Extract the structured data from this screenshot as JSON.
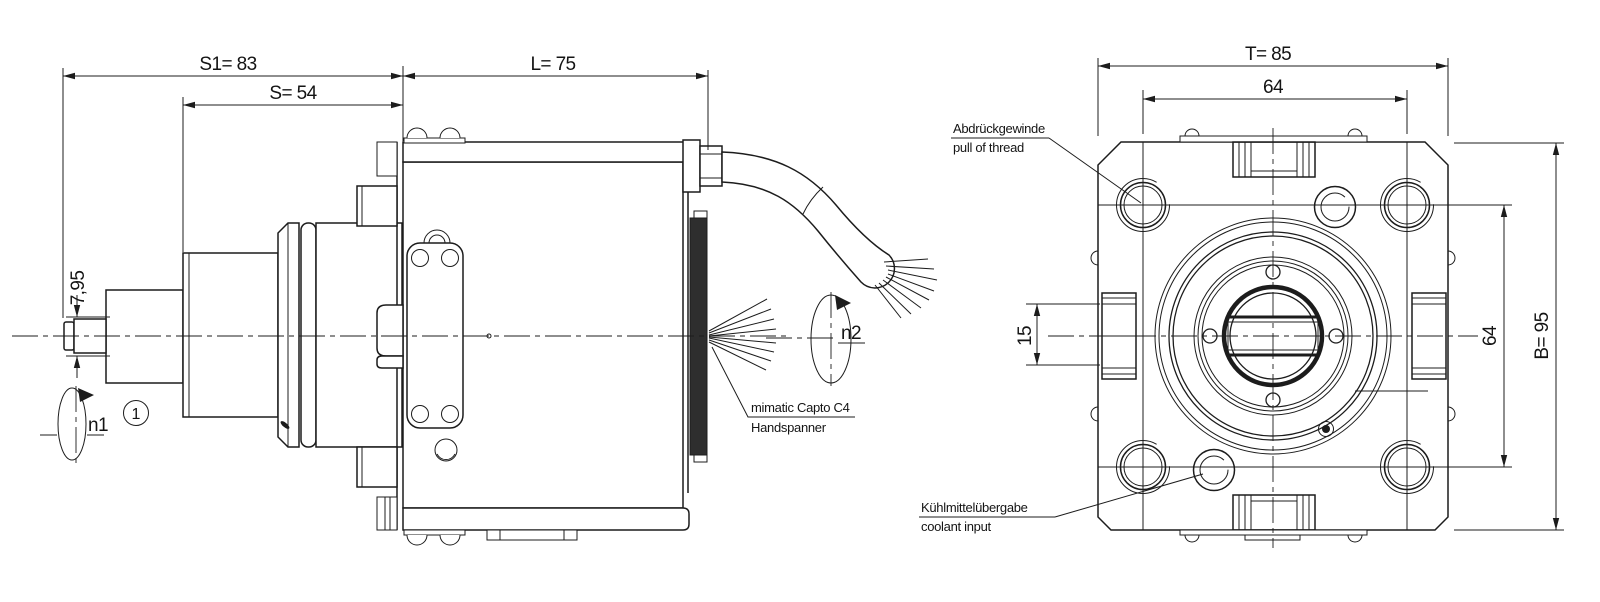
{
  "side_view": {
    "dim_s1": "S1= 83",
    "dim_s": "S= 54",
    "dim_l": "L= 75",
    "dim_shaft_dia": "7,95",
    "speed_label_1": "n1",
    "speed_label_2": "n2",
    "balloon_1": "1",
    "capto_label_line1": "mimatic Capto C4",
    "capto_label_line2": "Handspanner"
  },
  "front_view": {
    "dim_t": "T= 85",
    "dim_width_64": "64",
    "dim_b": "B= 95",
    "dim_height_64": "64",
    "dim_clamp_15": "15",
    "thread_label_line1": "Abdrückgewinde",
    "thread_label_line2": "pull of thread",
    "coolant_label_line1": "Kühlmittelübergabe",
    "coolant_label_line2": "coolant input"
  },
  "colors": {
    "line": "#1c1c1c",
    "background": "#ffffff"
  }
}
